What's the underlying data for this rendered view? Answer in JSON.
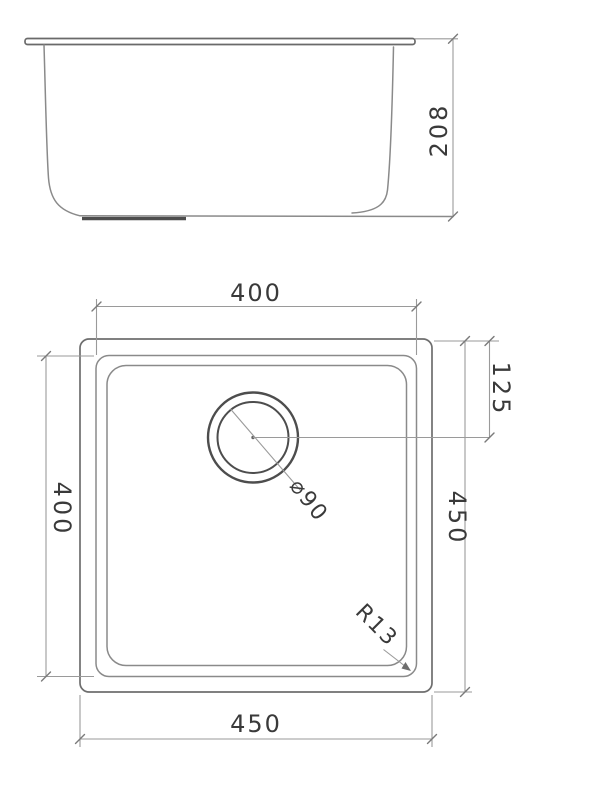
{
  "colors": {
    "line": "#8a8a8a",
    "outline_dark": "#4d4d4d",
    "dimension_line": "#9a9a9a",
    "text": "#3a3a3a",
    "background": "#ffffff"
  },
  "side_view": {
    "depth_label": "208"
  },
  "plan_view": {
    "bowl_width_label": "400",
    "bowl_height_label": "400",
    "overall_width_label": "450",
    "overall_height_label": "450",
    "drain_offset_label": "125",
    "drain_diameter_label": "⌀90",
    "corner_radius_label": "R13"
  }
}
